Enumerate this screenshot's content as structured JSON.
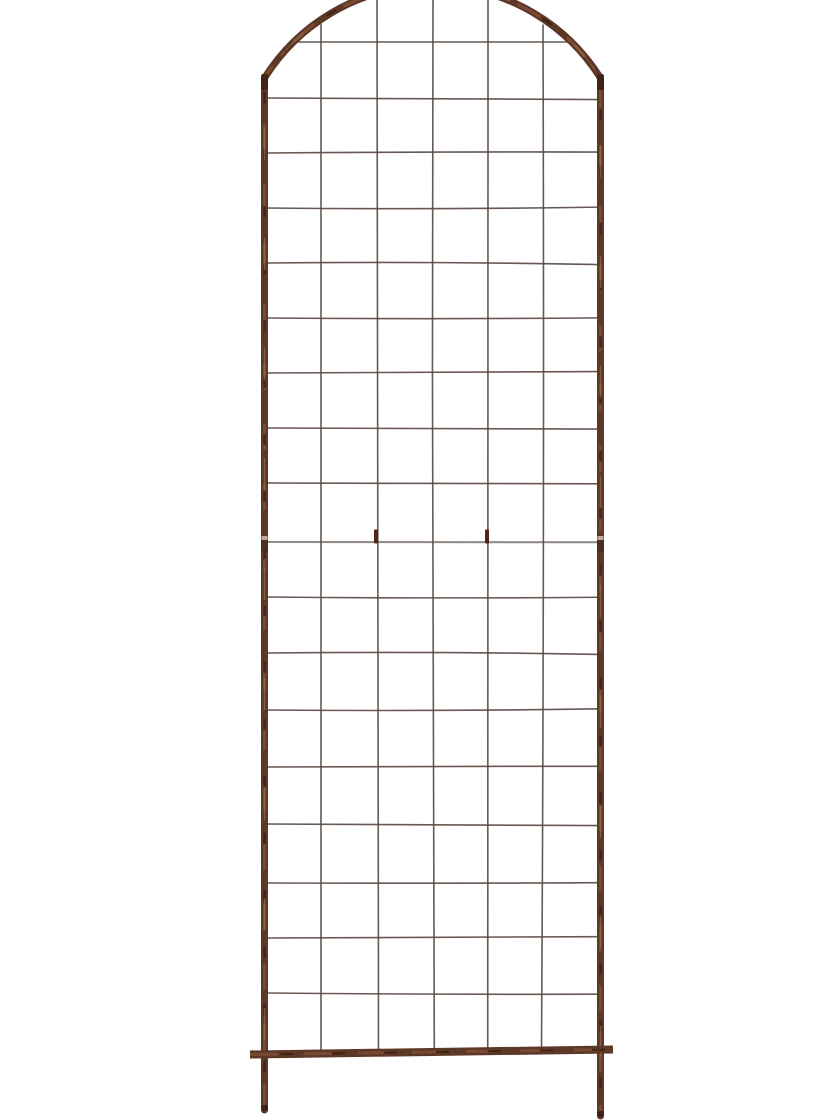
{
  "scene": {
    "subject": "arched-wire-grid-garden-trellis",
    "background_color": "#ffffff"
  },
  "palette": {
    "frame_brown": "#5d3827",
    "frame_brown_dark": "#3a2015",
    "frame_brown_mid": "#7c4c33",
    "frame_brown_light": "#9a6e4d",
    "wire_brown": "#5a4a42",
    "joint_wire_gray": "#8f8682",
    "joint_tab_dark": "#50261b",
    "sleeve_light": "#cbb6a4",
    "sleeve_dark": "#4a2a1d",
    "leg_tip_dark": "#381e14"
  },
  "geometry": {
    "canvas": {
      "width": 840,
      "height": 1120
    },
    "frame": {
      "left_rail_x": 264.5,
      "right_rail_x": 600.5,
      "rail_top_y": 78,
      "arch_radius": 198.5,
      "rail_stroke_width": 7,
      "left_leg_bottom_y": 1110,
      "right_leg_bottom_y": 1116,
      "elbow_joint_y": 74,
      "mid_sleeve_y": 536
    },
    "bottom_bar": {
      "x1": 250,
      "y1": 1054.5,
      "x2": 613,
      "y2": 1049.5,
      "stroke_width": 8
    },
    "grid": {
      "wire_stroke_width": 1.6,
      "joint_wire_stroke_width": 2.1,
      "vertical_xs": [
        321,
        377,
        433,
        488,
        543
      ],
      "vertical_top_ys": [
        24,
        0,
        0,
        0,
        25
      ],
      "vertical_bottom_y": 1050,
      "horizontal_ys": [
        42,
        98,
        153,
        208,
        263,
        318,
        373,
        428,
        483,
        542,
        597,
        653,
        710,
        767,
        824,
        883,
        938,
        993
      ],
      "row_x1": 266,
      "row_x2": 599,
      "first_row_span": [
        295.5,
        571
      ],
      "joint_row_y": 542,
      "joint_tabs_x": [
        376,
        487
      ],
      "joint_tab_top_y": 529.5,
      "joint_tab_height": 14
    }
  }
}
